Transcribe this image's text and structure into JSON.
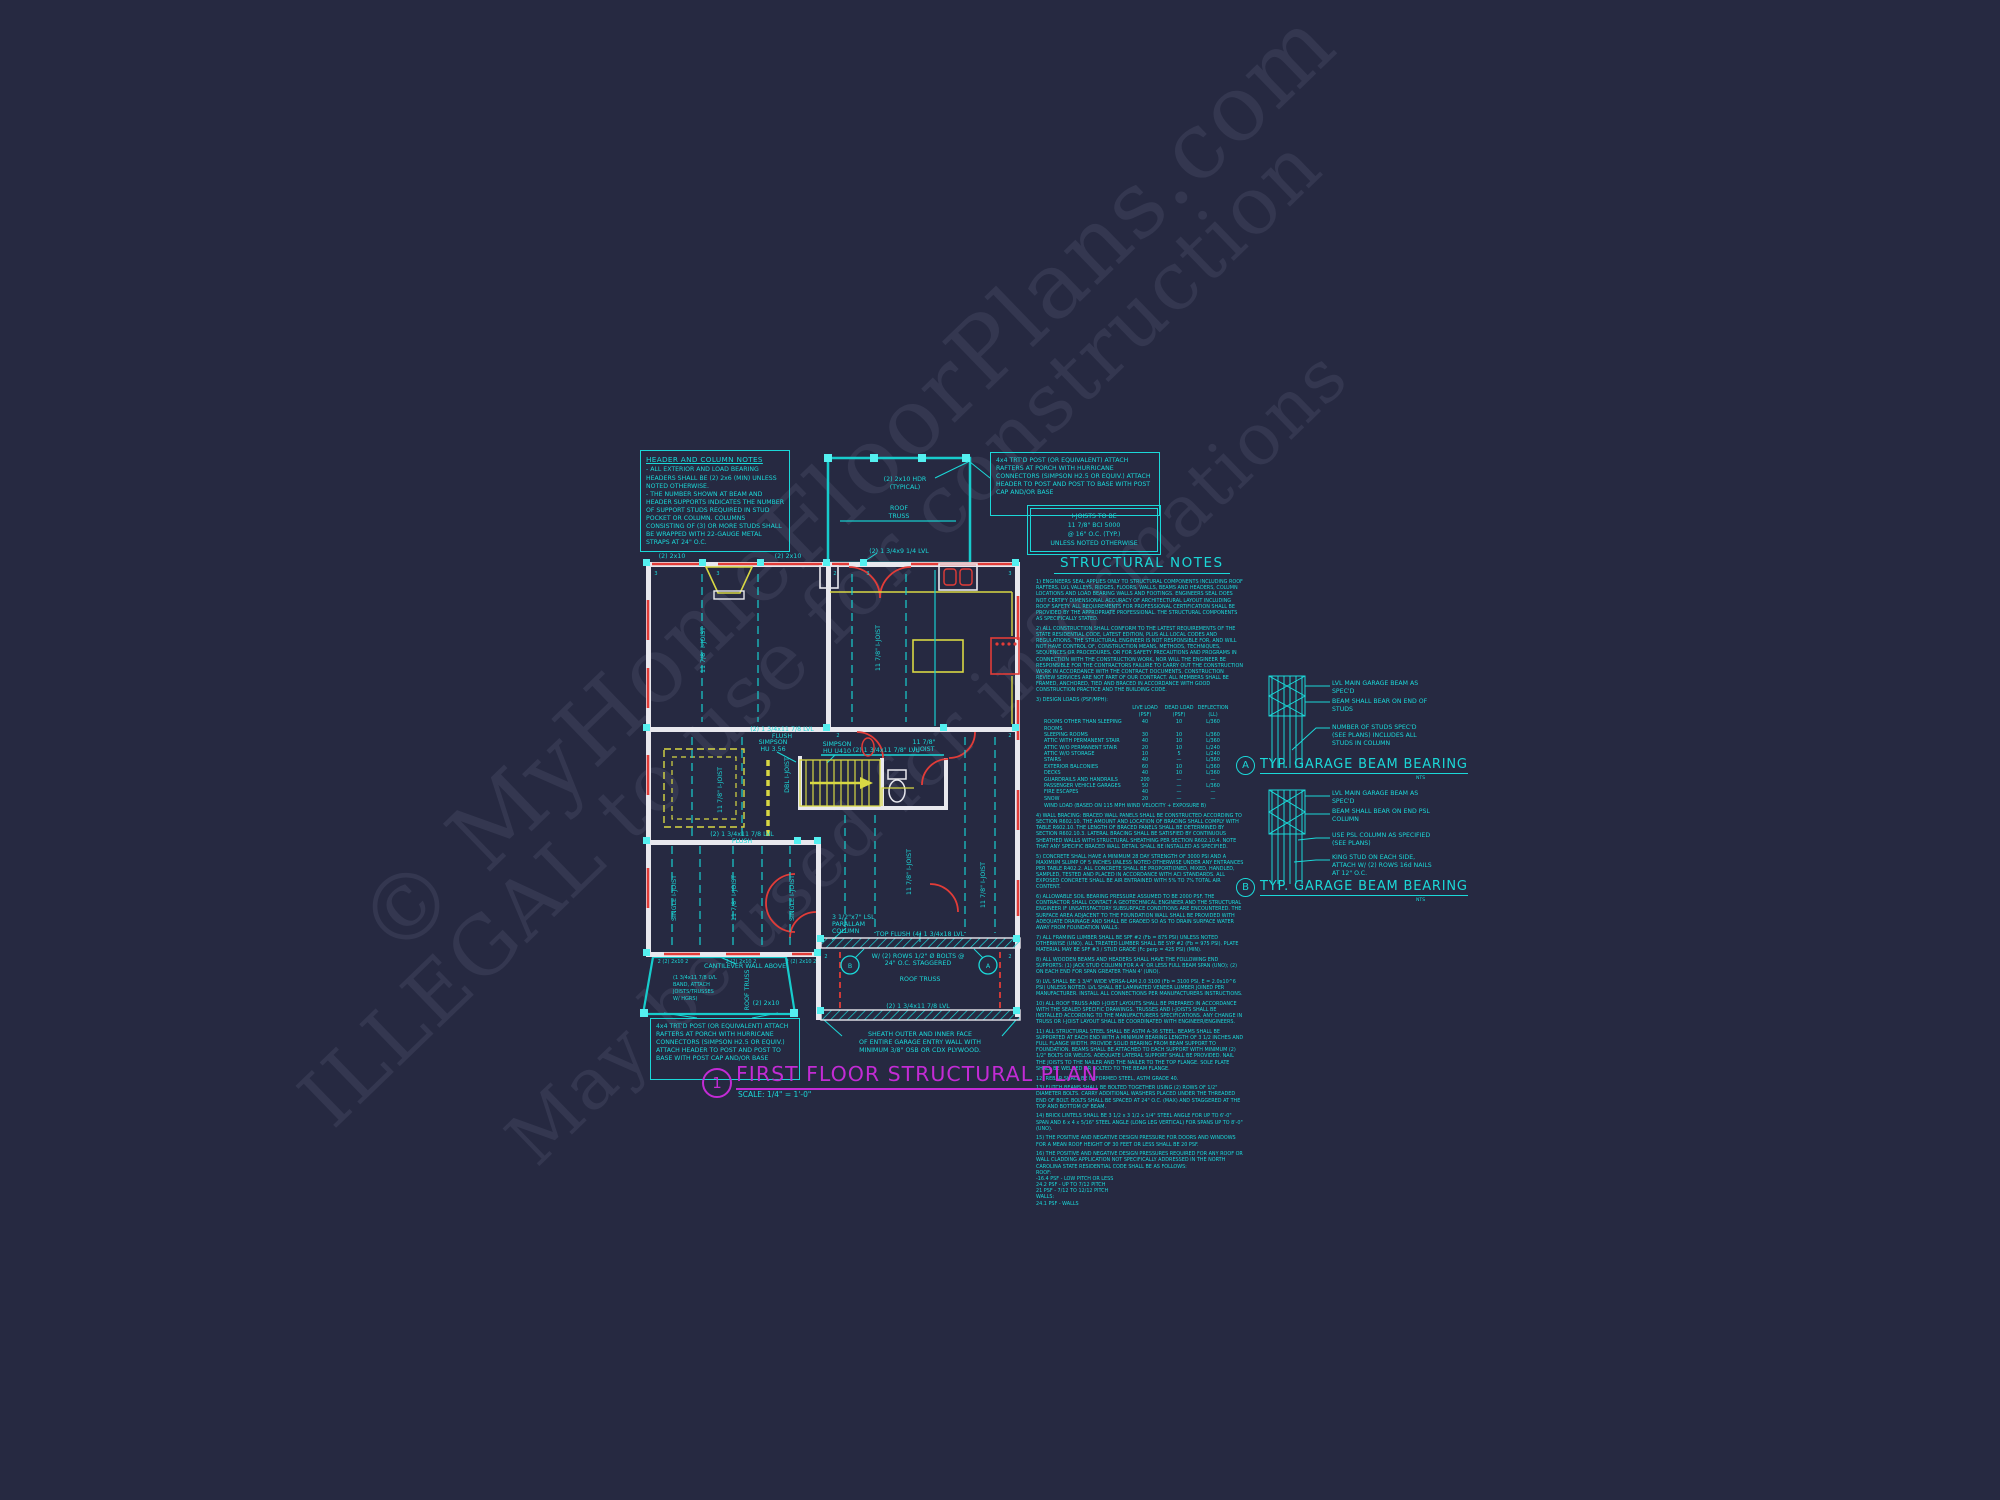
{
  "watermark": {
    "line1": "© MyHomeFloorPlans.com",
    "line2": "ILLEGAL to use for construction",
    "line3": "May be used for informations"
  },
  "header_column_notes": {
    "title": "HEADER AND COLUMN NOTES",
    "p1": "- ALL EXTERIOR AND LOAD BEARING HEADERS SHALL BE (2) 2x6 (MIN) UNLESS NOTED OTHERWISE.",
    "p2": "- THE NUMBER SHOWN AT BEAM AND HEADER SUPPORTS INDICATES THE NUMBER OF SUPPORT STUDS REQUIRED IN STUD POCKET OR COLUMN. COLUMNS CONSISTING OF (3) OR MORE STUDS SHALL BE WRAPPED WITH 22-GAUGE METAL STRAPS AT 24\" O.C."
  },
  "post_note": {
    "text": "4x4 TRT'D POST (OR EQUIVALENT) ATTACH RAFTERS AT PORCH WITH HURRICANE CONNECTORS (SIMPSON H2.5 OR EQUIV.) ATTACH HEADER TO POST AND POST TO BASE WITH POST CAP AND/OR BASE"
  },
  "ijoist_note": {
    "l1": "I-JOISTS TO BE",
    "l2": "11 7/8\" BCI 5000",
    "l3": "@ 16\" O.C. (TYP.)",
    "l4": "UNLESS NOTED OTHERWISE"
  },
  "structural_notes": {
    "title": "STRUCTURAL NOTES",
    "intro_notes": [
      "1) ENGINEERS SEAL APPLIES ONLY TO STRUCTURAL COMPONENTS INCLUDING ROOF RAFTERS, LVL VALLEYS, RIDGES, FLOORS, WALLS, BEAMS AND HEADERS, COLUMN LOCATIONS AND LOAD BEARING WALLS AND FOOTINGS. ENGINEERS SEAL DOES NOT CERTIFY DIMENSIONAL ACCURACY OF ARCHITECTURAL LAYOUT INCLUDING ROOF SAFETY. ALL REQUIREMENTS FOR PROFESSIONAL CERTIFICATION SHALL BE PROVIDED BY THE APPROPRIATE PROFESSIONAL. THE STRUCTURAL COMPONENTS AS SPECIFICALLY STATED.",
      "2) ALL CONSTRUCTION SHALL CONFORM TO THE LATEST REQUIREMENTS OF THE STATE RESIDENTIAL CODE, LATEST EDITION, PLUS ALL LOCAL CODES AND REGULATIONS. THE STRUCTURAL ENGINEER IS NOT RESPONSIBLE FOR, AND WILL NOT HAVE CONTROL OF, CONSTRUCTION MEANS, METHODS, TECHNIQUES, SEQUENCES OR PROCEDURES, OR FOR SAFETY PRECAUTIONS AND PROGRAMS IN CONNECTION WITH THE CONSTRUCTION WORK, NOR WILL THE ENGINEER BE RESPONSIBLE FOR THE CONTRACTORS FAILURE TO CARRY OUT THE CONSTRUCTION WORK IN ACCORDANCE WITH THE CONTRACT DOCUMENTS. CONSTRUCTION REVIEW SERVICES ARE NOT PART OF OUR CONTRACT. ALL MEMBERS SHALL BE FRAMED, ANCHORED, TIED AND BRACED IN ACCORDANCE WITH GOOD CONSTRUCTION PRACTICE AND THE BUILDING CODE."
    ],
    "loads": {
      "heading": "3) DESIGN LOADS (PSF/MPH):",
      "columns": [
        "LIVE LOAD (PSF)",
        "DEAD LOAD (PSF)",
        "DEFLECTION (LL)"
      ],
      "rows": [
        [
          "ROOMS OTHER THAN SLEEPING ROOMS",
          "40",
          "10",
          "L/360"
        ],
        [
          "SLEEPING ROOMS",
          "30",
          "10",
          "L/360"
        ],
        [
          "ATTIC WITH PERMANENT STAIR",
          "40",
          "10",
          "L/360"
        ],
        [
          "ATTIC W/O PERMANENT STAIR",
          "20",
          "10",
          "L/240"
        ],
        [
          "ATTIC W/O STORAGE",
          "10",
          "5",
          "L/240"
        ],
        [
          "STAIRS",
          "40",
          "—",
          "L/360"
        ],
        [
          "EXTERIOR BALCONIES",
          "60",
          "10",
          "L/360"
        ],
        [
          "DECKS",
          "40",
          "10",
          "L/360"
        ],
        [
          "GUARDRAILS AND HANDRAILS",
          "200",
          "—",
          "—"
        ],
        [
          "PASSENGER VEHICLE GARAGES",
          "50",
          "—",
          "L/360"
        ],
        [
          "FIRE ESCAPES",
          "40",
          "—",
          "—"
        ],
        [
          "SNOW",
          "20",
          "—",
          "—"
        ]
      ],
      "wind_row": "WIND LOAD      (BASED ON 115 MPH WIND VELOCITY + EXPOSURE B)"
    },
    "notes": [
      "4) WALL BRACING: BRACED WALL PANELS SHALL BE CONSTRUCTED ACCORDING TO SECTION R602.10. THE AMOUNT AND LOCATION OF BRACING SHALL COMPLY WITH TABLE R602.10. THE LENGTH OF BRACED PANELS SHALL BE DETERMINED BY SECTION R602.10.3. LATERAL BRACING SHALL BE SATISFIED BY CONTINUOUS SHEATHED WALLS WITH STRUCTURAL SHEATHING PER SECTION R602.10.4. NOTE THAT ANY SPECIFIC BRACED WALL DETAIL SHALL BE INSTALLED AS SPECIFIED.",
      "5) CONCRETE SHALL HAVE A MINIMUM 28 DAY STRENGTH OF 3000 PSI AND A MAXIMUM SLUMP OF 5 INCHES UNLESS NOTED OTHERWISE UNDER ANY ENTRANCES PER TABLE R402.2. ALL CONCRETE SHALL BE PROPORTIONED, MIXED, HANDLED, SAMPLED, TESTED AND PLACED IN ACCORDANCE WITH ACI STANDARDS. ALL EXPOSED CONCRETE SHALL BE AIR ENTRAINED WITH 5% TO 7% TOTAL AIR CONTENT.",
      "6) ALLOWABLE SOIL BEARING PRESSURE ASSUMED TO BE 2000 PSF. THE CONTRACTOR SHALL CONTACT A GEOTECHNICAL ENGINEER AND THE STRUCTURAL ENGINEER IF UNSATISFACTORY SUBSURFACE CONDITIONS ARE ENCOUNTERED. THE SURFACE AREA ADJACENT TO THE FOUNDATION WALL SHALL BE PROVIDED WITH ADEQUATE DRAINAGE AND SHALL BE GRADED SO AS TO DRAIN SURFACE WATER AWAY FROM FOUNDATION WALLS.",
      "7) ALL FRAMING LUMBER SHALL BE SPF #2 (Fb = 875 PSI) UNLESS NOTED OTHERWISE (UNO). ALL TREATED LUMBER SHALL BE SYP #2 (Fb = 975 PSI). PLATE MATERIAL MAY BE SPF #3 / STUD GRADE (Fc perp = 425 PSI) (MIN).",
      "8) ALL WOODEN BEAMS AND HEADERS SHALL HAVE THE FOLLOWING END SUPPORTS: (1) JACK STUD COLUMN FOR A 4' OR LESS FULL BEAM SPAN (UNO); (2) ON EACH END FOR SPAN GREATER THAN 4' (UNO).",
      "9) LVL SHALL BE 1 3/4\" WIDE VERSA-LAM 2.0 3100 (Fb = 3100 PSI, E = 2.0x10^6 PSI) UNLESS NOTED. LVL SHALL BE LAMINATED VENEER LUMBER JOINED PER MANUFACTURER. INSTALL ALL CONNECTIONS PER MANUFACTURERS INSTRUCTIONS.",
      "10) ALL ROOF TRUSS AND I-JOIST LAYOUTS SHALL BE PREPARED IN ACCORDANCE WITH THE SEALED SPECIFIC DRAWINGS. TRUSSES AND I-JOISTS SHALL BE INSTALLED ACCORDING TO THE MANUFACTURERS SPECIFICATIONS. ANY CHANGE IN TRUSS OR I-JOIST LAYOUT SHALL BE COORDINATED WITH ENGINEER/ENGINEERS.",
      "11) ALL STRUCTURAL STEEL SHALL BE ASTM A-36 STEEL. BEAMS SHALL BE SUPPORTED AT EACH END WITH A MINIMUM BEARING LENGTH OF 3 1/2 INCHES AND FULL FLANGE WIDTH. PROVIDE SOLID BEARING FROM BEAM SUPPORT TO FOUNDATION. BEAMS SHALL BE ATTACHED TO EACH SUPPORT WITH MINIMUM (2) 1/2\" BOLTS OR WELDS. ADEQUATE LATERAL SUPPORT SHALL BE PROVIDED. NAIL THE JOISTS TO THE NAILER AND THE NAILER TO THE TOP FLANGE. SOLE PLATE SHALL BE WELDED OR BOLTED TO THE BEAM FLANGE.",
      "12) REBAR SHALL BE DEFORMED STEEL, ASTM GRADE 40.",
      "13) FLITCH BEAMS SHALL BE BOLTED TOGETHER USING (2) ROWS OF 1/2\" DIAMETER BOLTS. CARRY ADDITIONAL WASHERS PLACED UNDER THE THREADED END OF BOLT. BOLTS SHALL BE SPACED AT 24\" O.C. (MAX) AND STAGGERED AT THE TOP AND BOTTOM OF BEAM.",
      "14) BRICK LINTELS SHALL BE 3 1/2 x 3 1/2 x 1/4\" STEEL ANGLE FOR UP TO 6'-0\" SPAN AND 6 x 4 x 5/16\" STEEL ANGLE (LONG LEG VERTICAL) FOR SPANS UP TO 8'-0\" (UNO).",
      "15) THE POSITIVE AND NEGATIVE DESIGN PRESSURE FOR DOORS AND WINDOWS FOR A MEAN ROOF HEIGHT OF 30 FEET OR LESS SHALL BE 20 PSF.",
      "16) THE POSITIVE AND NEGATIVE DESIGN PRESSURES REQUIRED FOR ANY ROOF OR WALL CLADDING APPLICATION NOT SPECIFICALLY ADDRESSED IN THE NORTH CAROLINA STATE RESIDENTIAL CODE SHALL BE AS FOLLOWS:\nROOF:\n    -16.4 PSF - LOW PITCH OR LESS\n    24.2 PSF - UP TO 7/12 PITCH\n    21 PSF - 7/12 TO 12/12 PITCH\nWALLS:\n    24.1 PSF - WALLS"
    ]
  },
  "details": {
    "a": {
      "tag": "A",
      "title": "TYP. GARAGE BEAM BEARING",
      "scale": "NTS",
      "c1": "LVL MAIN GARAGE BEAM AS SPEC'D",
      "c2": "BEAM SHALL BEAR ON END OF STUDS",
      "c3": "NUMBER OF STUDS SPEC'D (SEE PLANS) INCLUDES ALL STUDS IN COLUMN"
    },
    "b": {
      "tag": "B",
      "title": "TYP. GARAGE BEAM BEARING",
      "scale": "NTS",
      "c1": "LVL MAIN GARAGE BEAM AS SPEC'D",
      "c2": "BEAM SHALL BEAR ON END PSL COLUMN",
      "c3": "USE PSL COLUMN AS SPECIFIED (SEE PLANS)",
      "c4": "KING STUD ON EACH SIDE, ATTACH W/ (2) ROWS 16d NAILS AT 12\" O.C."
    }
  },
  "plan": {
    "labels": {
      "top_2x10": "(2) 2x10",
      "hdr1": "(2) 2x10 HDR",
      "hdr2": "(TYPICAL)",
      "roof1": "ROOF",
      "roof2": "TRUSS",
      "lvl914": "(2) 1 3/4x9 1/4 LVL",
      "ijoist": "11 7/8\" I-JOIST",
      "single": "SINGLE I-JOIST",
      "dbl": "DBL I-JOIST",
      "simpson1a": "SIMPSON",
      "simpson1b": "HU 3.56",
      "simpson2a": "SIMPSON",
      "simpson2b": "HU U410",
      "lvl1178": "(2) 1 3/4x11 7/8\" LVL",
      "ij1": "11 7/8\"",
      "ij2": "I-JOIST",
      "flush1": "(2) 1 3/4x11 7/8 LVL",
      "flush2": "FLUSH",
      "lsl1": "3 1/2\"x7\" LSL",
      "lsl2": "PARALLAM",
      "lsl3": "COLUMN",
      "topflush": "TOP FLUSH (4) 1 3/4x18 LVL",
      "bolts1": "W/ (2) ROWS 1/2\" Ø BOLTS @",
      "bolts2": "24\" O.C. STAGGERED",
      "rooftruss": "ROOF TRUSS",
      "lvlgarage": "(2) 1 3/4x11 7/8 LVL",
      "cant1": "CANTILEVER WALL ABOVE",
      "cant2": "(1 3/4x11 7/8 LVL",
      "cant3": "BAND, ATTACH",
      "cant4": "JOISTS/TRUSSES",
      "cant5": "W/ HGRS)",
      "rtvert": "ROOF TRUSS",
      "c2x10": "(2) 2x10",
      "bh": "2 (2) 2x10 2",
      "sheath1": "SHEATH OUTER AND INNER FACE",
      "sheath2": "OF ENTIRE GARAGE ENTRY WALL WITH",
      "sheath3": "MINIMUM 3/8\" OSB OR CDX PLYWOOD.",
      "mA": "A",
      "mB": "B",
      "s3": "3",
      "s2": "2"
    }
  },
  "title_block": {
    "number": "1",
    "title": "FIRST FLOOR STRUCTURAL PLAN",
    "scale": "SCALE: 1/4\" = 1'-0\""
  }
}
